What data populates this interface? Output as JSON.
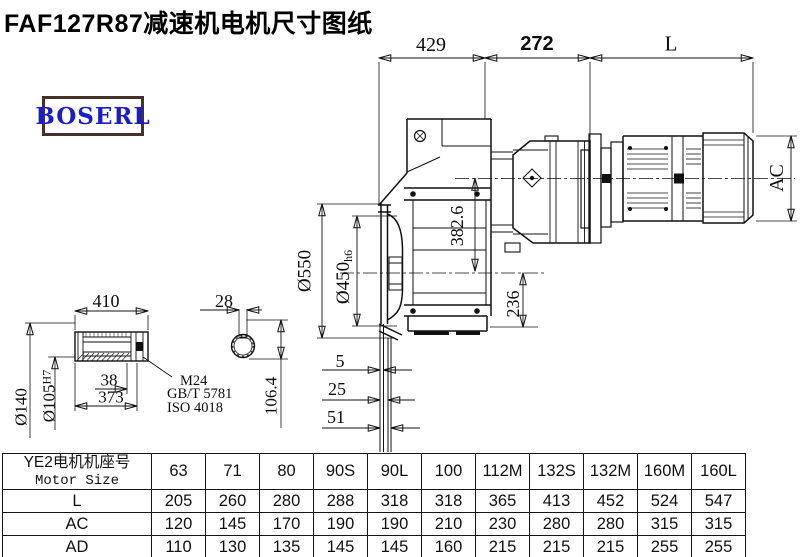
{
  "title": "FAF127R87减速机电机尺寸图纸",
  "logo": {
    "text": "BOSERL"
  },
  "colors": {
    "line": "#111111",
    "logo_text": "#1c1ccc",
    "logo_border": "#46312a"
  },
  "dims": {
    "top_width_1": "429",
    "top_width_2": "272",
    "motor_length": "L",
    "motor_diameter": "AC",
    "flange_od": "Ø550",
    "spigot_d": "Ø450",
    "spigot_tol": "h6",
    "axis_height": "382.6",
    "base_height": "236",
    "offset_1": "5",
    "offset_2": "25",
    "offset_3": "51",
    "shaft_length": "410",
    "shaft_od": "Ø140",
    "bore_d": "Ø105",
    "bore_tol": "H7",
    "key_width": "28",
    "key_height": "106.4",
    "dim_38": "38",
    "dim_373": "373",
    "bolt": "M24",
    "bolt_std1": "GB/T 5781",
    "bolt_std2": "ISO 4018"
  },
  "table": {
    "header_cn": "YE2电机机座号",
    "header_en": "Motor Size",
    "columns": [
      "63",
      "71",
      "80",
      "90S",
      "90L",
      "100",
      "112M",
      "132S",
      "132M",
      "160M",
      "160L"
    ],
    "rows": [
      {
        "label": "L",
        "values": [
          "205",
          "260",
          "280",
          "288",
          "318",
          "318",
          "365",
          "413",
          "452",
          "524",
          "547"
        ]
      },
      {
        "label": "AC",
        "values": [
          "120",
          "145",
          "170",
          "190",
          "190",
          "210",
          "230",
          "280",
          "280",
          "315",
          "315"
        ]
      },
      {
        "label": "AD",
        "values": [
          "110",
          "130",
          "135",
          "145",
          "145",
          "160",
          "215",
          "215",
          "215",
          "255",
          "255"
        ]
      }
    ]
  }
}
